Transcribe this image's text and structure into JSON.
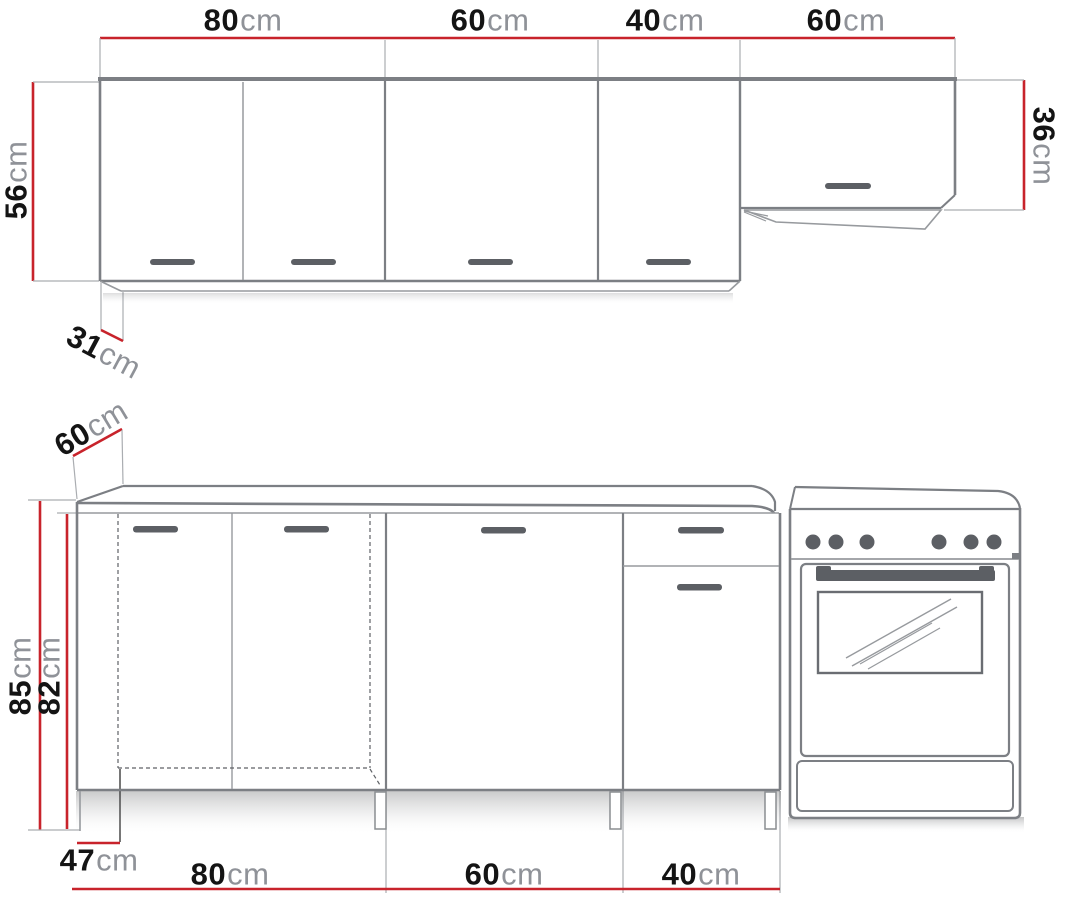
{
  "dimensions": {
    "unit": "cm",
    "wall_cabinets": {
      "widths": [
        "80",
        "60",
        "40",
        "60"
      ],
      "height": "56",
      "flap_height": "36",
      "depth": "31"
    },
    "base_cabinets": {
      "widths": [
        "80",
        "60",
        "40"
      ],
      "worktop_depth": "60",
      "height_with_worktop": "85",
      "carcass_height": "82",
      "front_depth": "47"
    }
  },
  "colors": {
    "dimension_line": "#c8232b",
    "number_text": "#141414",
    "unit_text": "#8f9298",
    "outline": "#7c7f84",
    "handle": "#5c5f64",
    "background": "#ffffff"
  }
}
